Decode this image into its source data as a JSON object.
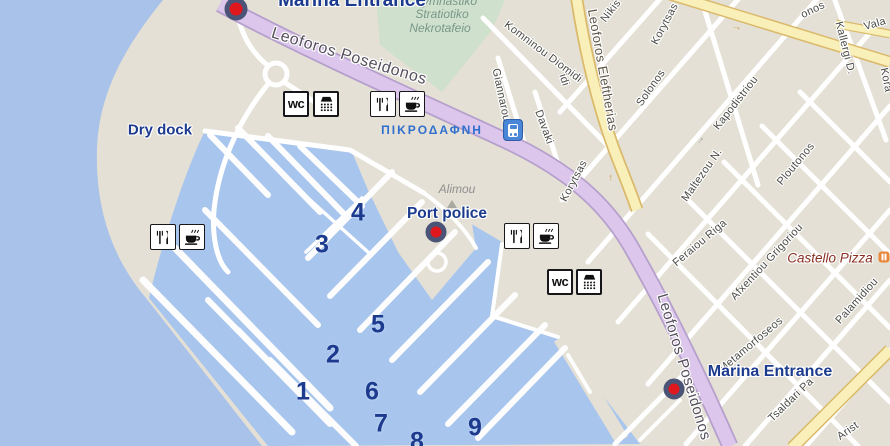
{
  "labels": {
    "marina_entrance_top": "Marina Entrance",
    "marina_entrance_bottom": "Marina Entrance",
    "port_police": "Port police",
    "dry_dock": "Dry dock",
    "alimou": "Alimou",
    "pikrodafni": "ΠΙΚΡΟΔΑΦΝΗ",
    "castello_pizza": "Castello Pizza",
    "cemetery_line1": "ymnastiko",
    "cemetery_line2": "Stratiotiko",
    "cemetery_line3": "Nekrotafeio",
    "wc": "wc"
  },
  "berths": [
    "1",
    "2",
    "3",
    "4",
    "5",
    "6",
    "7",
    "8",
    "9"
  ],
  "roads": {
    "poseidonos": "Leoforos Poseidonos",
    "eleftherias": "Leoforos Eleftherias"
  },
  "streets": {
    "nikis": "Nikis",
    "korytsas_top": "Korytsas",
    "korytsas_mid": "Korytsas",
    "solonos": "Solonos",
    "onos_fragment": "onos",
    "vala_fragment": "Vala",
    "korai_fragment": "Kora",
    "kallergi": "Kallergi D.",
    "kapodistriou": "Kapodistriou",
    "komninou_diomidi": "Komninou Diomidi",
    "giannarou": "Giannarou",
    "davaki": "Davaki",
    "idi_fragment": "idi",
    "maltezou": "Maltezou N.",
    "ploutonos": "Ploutonos",
    "feraiou_riga": "Feraiou Riga",
    "afxentiou_grigoriou": "Afxentiou Grigoriou",
    "metamorfoseos": "Metamorfoseos",
    "palamidiou": "Palamidiou",
    "tsaldari": "Tsaldari Pa",
    "arist_fragment": "Arist"
  },
  "icons": {
    "one_way_arrow": "→"
  },
  "colors": {
    "sea_water": "#a9c2e9",
    "marina_water": "#a8c5ee",
    "land": "#e4e0d5",
    "main_road_purple": "#dcc6ec",
    "secondary_road_yellow": "#f8f0b8",
    "park_green": "#cfe0cc",
    "marker_red": "#e0181d",
    "marker_ring": "#4b5476",
    "label_navy": "#1c3a8e",
    "station_blue": "#4a86d8",
    "poi_orange": "#e8883c"
  }
}
